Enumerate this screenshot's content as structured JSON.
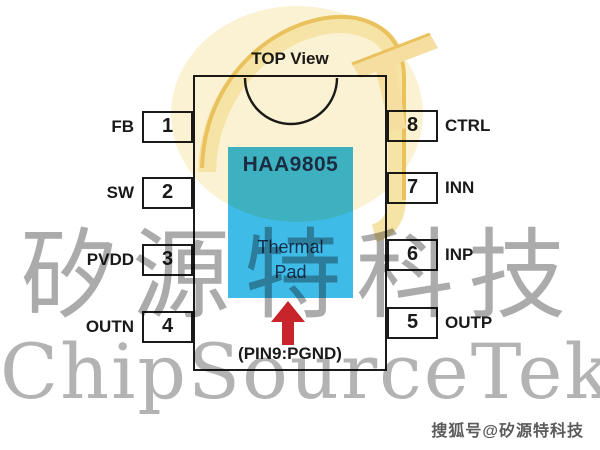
{
  "diagram": {
    "title": "TOP View",
    "part_number": "HAA9805",
    "thermal_pad_line1": "Thermal",
    "thermal_pad_line2": "Pad",
    "pad_note": "(PIN9:PGND)"
  },
  "pins": {
    "left": [
      {
        "number": "1",
        "name": "FB"
      },
      {
        "number": "2",
        "name": "SW"
      },
      {
        "number": "3",
        "name": "PVDD"
      },
      {
        "number": "4",
        "name": "OUTN"
      }
    ],
    "right": [
      {
        "number": "8",
        "name": "CTRL"
      },
      {
        "number": "7",
        "name": "INN"
      },
      {
        "number": "6",
        "name": "INP"
      },
      {
        "number": "5",
        "name": "OUTP"
      }
    ]
  },
  "watermark": {
    "cjk": "矽源特科技",
    "latin": "ChipSourceTek",
    "logo_icon": "chipsourcetek-monogram"
  },
  "footer": {
    "sohu_tag": "搜狐号@矽源特科技"
  },
  "colors": {
    "pad_blue": "#3FBBE8",
    "part_number_navy": "#1B2F4F",
    "arrow_red": "#C8242C",
    "line_black": "#1A1A1A",
    "logo_gold": "#E9C25E",
    "logo_pale": "#F6E3A6",
    "logo_halo": "#FBF2D4",
    "watermark_gray": "#ABABAB"
  }
}
